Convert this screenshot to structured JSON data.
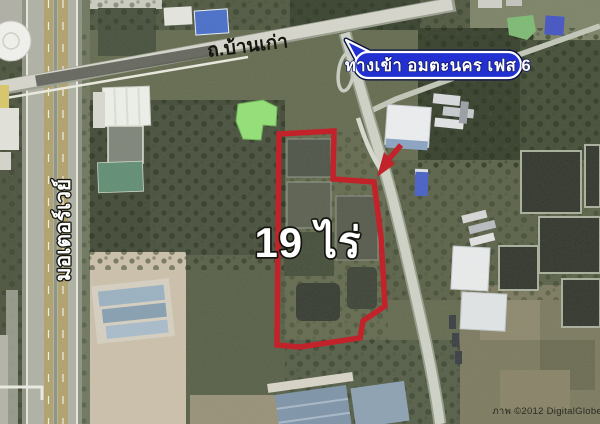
{
  "annotations": {
    "road_label": "ถ.บ้านเก่า",
    "motorway_label": "มอเตอร์เวย์",
    "plot_area_label": "19 ไร่",
    "entrance_callout": "ทางเข้า อมตะนคร เฟส 6",
    "credit": "ภาพ ©2012 DigitalGlobe"
  },
  "colors": {
    "plot_outline_red": "#c2232a",
    "arrow_red": "#c2232a",
    "callout_fill_blue": "#2230d2",
    "callout_border_white": "#ffffff",
    "label_text_white": "#ffffff",
    "road_label_black": "#16160f"
  }
}
